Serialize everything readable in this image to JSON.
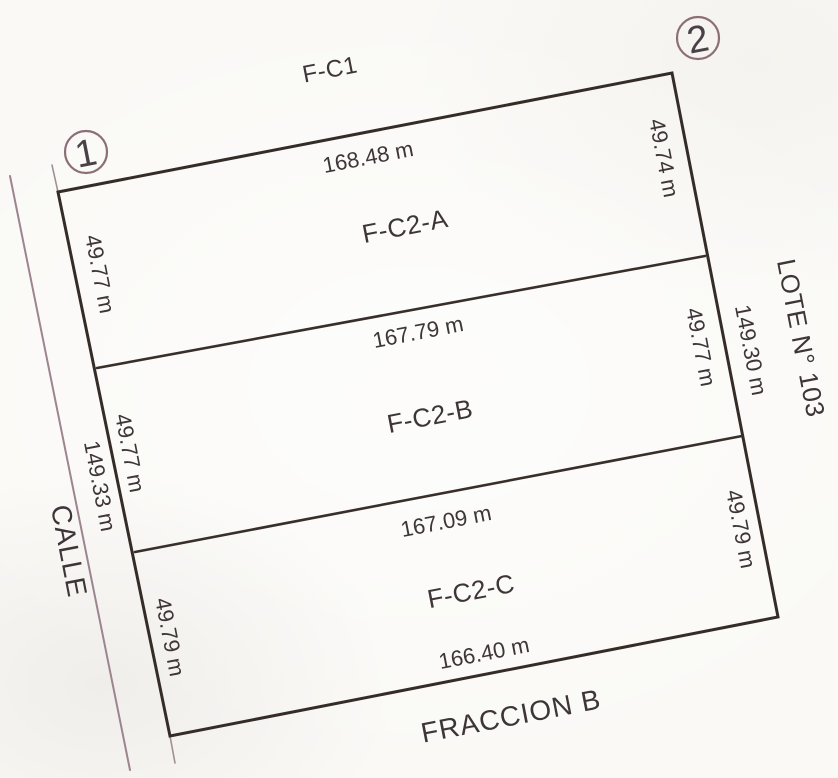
{
  "plan": {
    "neighbors": {
      "top": "F-C1",
      "right": "LOTE N° 103",
      "bottom": "FRACCION B",
      "street": "CALLE"
    },
    "vertices": [
      {
        "label": "1"
      },
      {
        "label": "2"
      }
    ],
    "totals": {
      "left_side": "149.33 m",
      "right_side": "149.30 m"
    },
    "parcels": [
      {
        "name": "F-C2-A",
        "north": "168.48 m",
        "west": "49.77 m",
        "east": "49.74 m"
      },
      {
        "name": "F-C2-B",
        "north": "167.79 m",
        "west": "49.77 m",
        "east": "49.77 m"
      },
      {
        "name": "F-C2-C",
        "north": "167.09 m",
        "west": "49.79 m",
        "east": "49.79 m",
        "south": "166.40 m"
      }
    ],
    "colors": {
      "boundary_line": "#352c28",
      "street_line": "#9c8490",
      "vertex_circle": "#8c6f76",
      "label_text": "#3e3538",
      "paper": "#faf9f6"
    }
  }
}
